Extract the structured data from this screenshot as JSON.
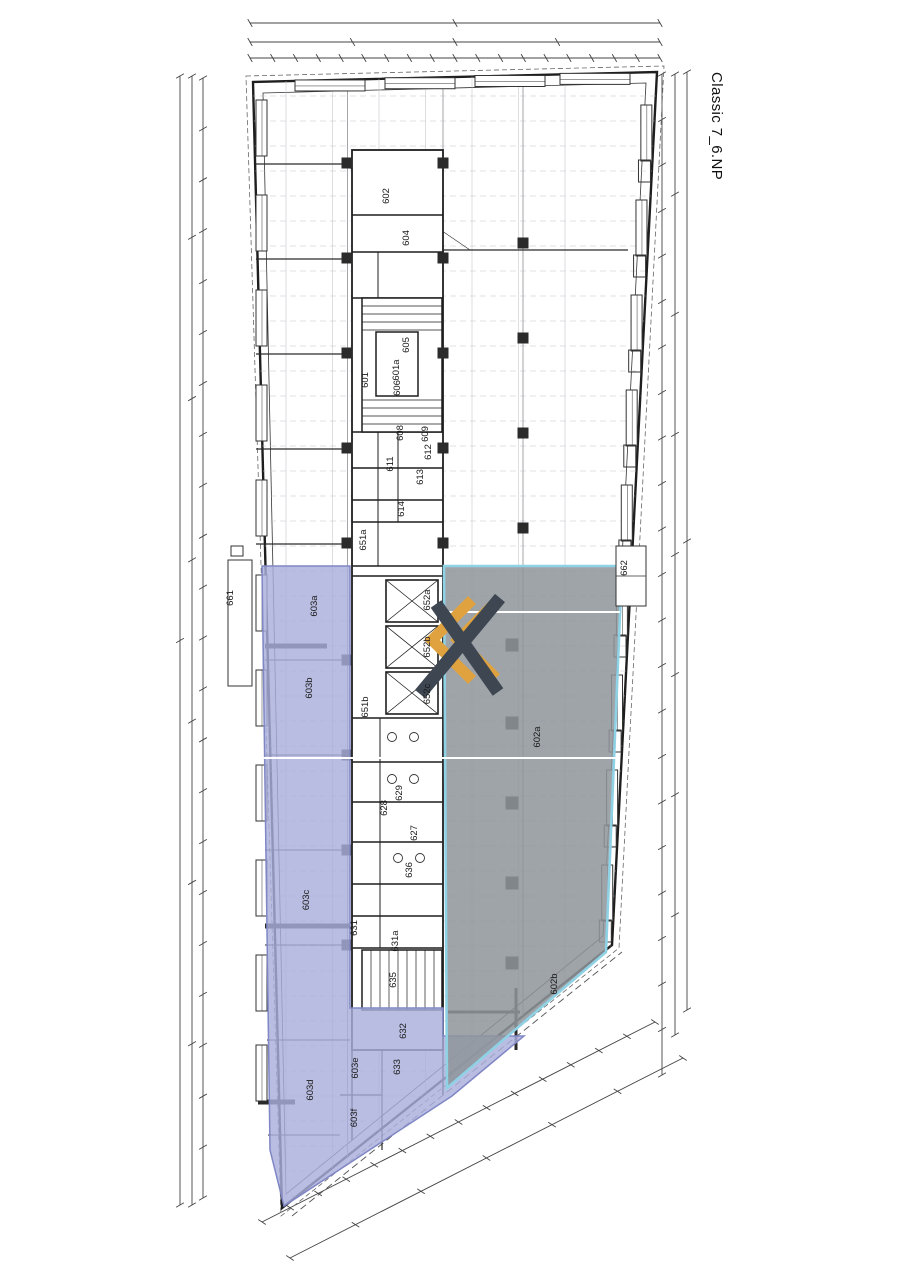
{
  "title": "Classic 7_6.NP",
  "colors": {
    "wall": "#1e1e1e",
    "dim": "#444444",
    "grid": "#c6c6cc",
    "blue_overlay": "#a9aeda",
    "blue_edge": "#8087c5",
    "gray_overlay": "#8f959b",
    "cyan_edge": "#8fd2e6",
    "logo_navy": "#3e4652",
    "logo_orange": "#e0a23e",
    "white_line": "#ffffff"
  },
  "logo": {
    "name": "kx-logo"
  },
  "rooms": [
    {
      "label": "602",
      "x": 389,
      "y": 196
    },
    {
      "label": "604",
      "x": 409,
      "y": 238
    },
    {
      "label": "601",
      "x": 368,
      "y": 380
    },
    {
      "label": "601a",
      "x": 399,
      "y": 370
    },
    {
      "label": "605",
      "x": 409,
      "y": 345
    },
    {
      "label": "606",
      "x": 400,
      "y": 388
    },
    {
      "label": "608",
      "x": 403,
      "y": 433
    },
    {
      "label": "609",
      "x": 428,
      "y": 434
    },
    {
      "label": "612",
      "x": 431,
      "y": 452
    },
    {
      "label": "611",
      "x": 393,
      "y": 464
    },
    {
      "label": "613",
      "x": 423,
      "y": 477
    },
    {
      "label": "614",
      "x": 404,
      "y": 509
    },
    {
      "label": "651a",
      "x": 366,
      "y": 540
    },
    {
      "label": "652a",
      "x": 430,
      "y": 600
    },
    {
      "label": "652b",
      "x": 430,
      "y": 647
    },
    {
      "label": "652c",
      "x": 430,
      "y": 694
    },
    {
      "label": "651b",
      "x": 368,
      "y": 707
    },
    {
      "label": "629",
      "x": 402,
      "y": 793
    },
    {
      "label": "628",
      "x": 387,
      "y": 808
    },
    {
      "label": "627",
      "x": 417,
      "y": 833
    },
    {
      "label": "636",
      "x": 412,
      "y": 870
    },
    {
      "label": "631",
      "x": 357,
      "y": 928
    },
    {
      "label": "631a",
      "x": 398,
      "y": 941
    },
    {
      "label": "635",
      "x": 396,
      "y": 980
    },
    {
      "label": "632",
      "x": 406,
      "y": 1031
    },
    {
      "label": "633",
      "x": 400,
      "y": 1067
    },
    {
      "label": "661",
      "x": 233,
      "y": 598
    },
    {
      "label": "662",
      "x": 627,
      "y": 568
    },
    {
      "label": "603a",
      "x": 317,
      "y": 606
    },
    {
      "label": "603b",
      "x": 312,
      "y": 688
    },
    {
      "label": "603c",
      "x": 309,
      "y": 900
    },
    {
      "label": "603d",
      "x": 313,
      "y": 1090
    },
    {
      "label": "603e",
      "x": 358,
      "y": 1068
    },
    {
      "label": "603f",
      "x": 357,
      "y": 1118
    },
    {
      "label": "602a",
      "x": 540,
      "y": 737
    },
    {
      "label": "602b",
      "x": 557,
      "y": 984
    }
  ]
}
